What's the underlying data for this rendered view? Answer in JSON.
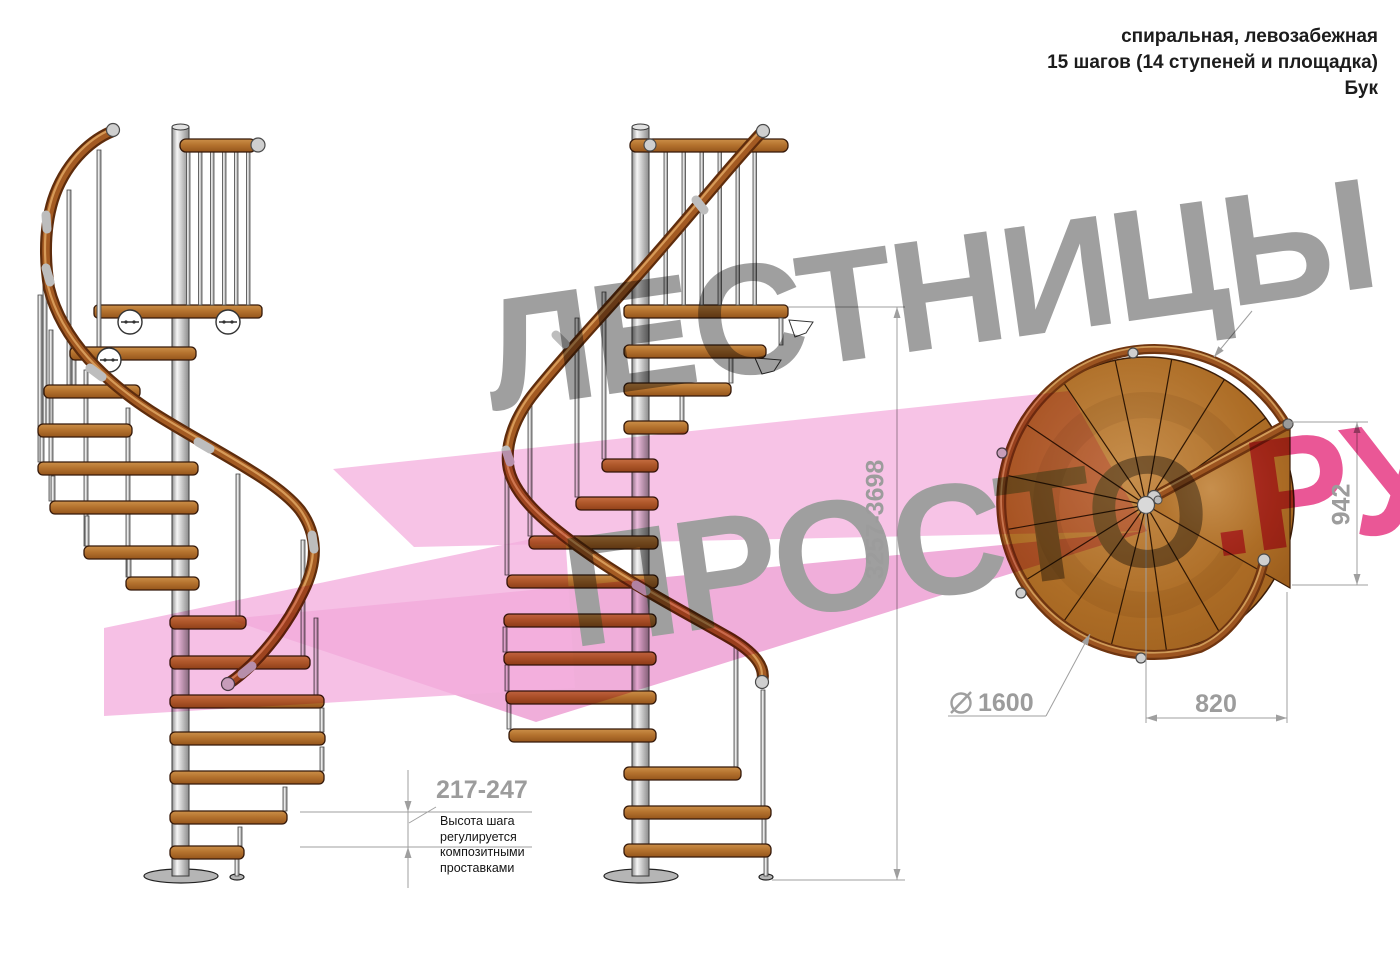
{
  "title": {
    "line1": "спиральная, левозабежная",
    "line2": "15 шагов (14 ступеней и площадка)",
    "line3": "Бук"
  },
  "watermark": {
    "line1": "ЛЕСТНИЦЫ",
    "line2_gray": "ПРОСТО",
    "line2_pink": ".РУ",
    "gray_color": "#9f9f9f",
    "pink_color": "#ea5796",
    "arrow_pink_color": "#f6b9e2"
  },
  "dimensions": {
    "step_height": "217-247",
    "step_height_note": "Высота шага\nрегулируется\nкомпозитными\nпроставками",
    "total_height": "3257-3698",
    "platform_depth": "942",
    "platform_width": "820",
    "diameter": "1600"
  },
  "drawing": {
    "views": [
      "боковой вид 1",
      "боковой вид 2",
      "вид сверху"
    ],
    "steps_total": 15,
    "treads": 14,
    "material_wood_color": "#b5732f",
    "handrail_color": "#7c3c12",
    "metal_color": "#d9d9d9",
    "dimension_color": "#9f9f9f"
  }
}
